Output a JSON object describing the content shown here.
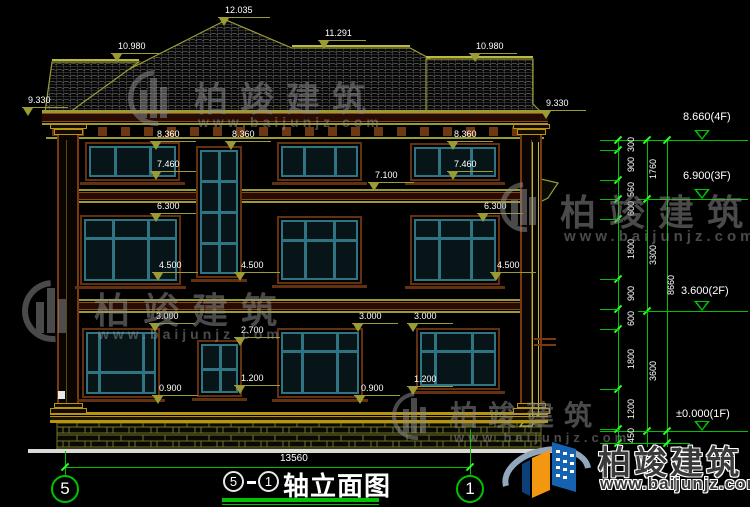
{
  "drawing": {
    "title": "轴立面图",
    "axis_left": "5",
    "axis_right": "1",
    "title_dash": "-",
    "bottom_overall_dim": "13560"
  },
  "watermark": {
    "name": "柏竣建筑",
    "url": "www.baijunjz.com"
  },
  "brand": {
    "name": "柏竣建筑",
    "url": "www.baijunjz.com"
  },
  "colors": {
    "background": "#000000",
    "dim_olive": "#9b9b33",
    "green": "#00c300",
    "window_teal": "#2e7482",
    "trim_brown": "#63310f",
    "base_yellow": "#b8960b",
    "white": "#ffffff",
    "logo_blue": "#1563b0",
    "logo_orange": "#f2970f"
  },
  "facade_dims": [
    {
      "label": "12.035",
      "tx": 225,
      "ty": 5,
      "lx": 218,
      "ly": 17,
      "lw": 52
    },
    {
      "label": "10.980",
      "tx": 118,
      "ty": 41,
      "lx": 111,
      "ly": 53,
      "lw": 48
    },
    {
      "label": "11.291",
      "tx": 325,
      "ty": 28,
      "lx": 318,
      "ly": 40,
      "lw": 48
    },
    {
      "label": "10.980",
      "tx": 476,
      "ty": 41,
      "lx": 469,
      "ly": 53,
      "lw": 48
    },
    {
      "label": "9.330",
      "tx": 28,
      "ty": 95,
      "lx": 22,
      "ly": 107,
      "lw": 46
    },
    {
      "label": "9.330",
      "tx": 546,
      "ty": 98,
      "lx": 540,
      "ly": 110,
      "lw": 46
    },
    {
      "label": "8.360",
      "tx": 157,
      "ty": 129,
      "lx": 150,
      "ly": 141,
      "lw": 46
    },
    {
      "label": "8.360",
      "tx": 232,
      "ty": 129,
      "lx": 225,
      "ly": 141,
      "lw": 46
    },
    {
      "label": "8.360",
      "tx": 454,
      "ty": 129,
      "lx": 447,
      "ly": 141,
      "lw": 46
    },
    {
      "label": "7.460",
      "tx": 157,
      "ty": 159,
      "lx": 150,
      "ly": 171,
      "lw": 46
    },
    {
      "label": "7.460",
      "tx": 454,
      "ty": 159,
      "lx": 447,
      "ly": 171,
      "lw": 46
    },
    {
      "label": "7.100",
      "tx": 375,
      "ty": 170,
      "lx": 368,
      "ly": 182,
      "lw": 46
    },
    {
      "label": "6.300",
      "tx": 157,
      "ty": 201,
      "lx": 150,
      "ly": 213,
      "lw": 46
    },
    {
      "label": "6.300",
      "tx": 484,
      "ty": 201,
      "lx": 477,
      "ly": 213,
      "lw": 46
    },
    {
      "label": "4.500",
      "tx": 159,
      "ty": 260,
      "lx": 152,
      "ly": 272,
      "lw": 46
    },
    {
      "label": "4.500",
      "tx": 241,
      "ty": 260,
      "lx": 234,
      "ly": 272,
      "lw": 46
    },
    {
      "label": "4.500",
      "tx": 497,
      "ty": 260,
      "lx": 490,
      "ly": 272,
      "lw": 46
    },
    {
      "label": "3.000",
      "tx": 156,
      "ty": 311,
      "lx": 149,
      "ly": 323,
      "lw": 46
    },
    {
      "label": "3.000",
      "tx": 359,
      "ty": 311,
      "lx": 352,
      "ly": 323,
      "lw": 46
    },
    {
      "label": "3.000",
      "tx": 414,
      "ty": 311,
      "lx": 407,
      "ly": 323,
      "lw": 46
    },
    {
      "label": "2.700",
      "tx": 241,
      "ty": 325,
      "lx": 234,
      "ly": 337,
      "lw": 46
    },
    {
      "label": "1.200",
      "tx": 241,
      "ty": 373,
      "lx": 234,
      "ly": 385,
      "lw": 46
    },
    {
      "label": "1.200",
      "tx": 414,
      "ty": 374,
      "lx": 407,
      "ly": 386,
      "lw": 46
    },
    {
      "label": "0.900",
      "tx": 159,
      "ty": 383,
      "lx": 152,
      "ly": 395,
      "lw": 46
    },
    {
      "label": "0.900",
      "tx": 361,
      "ty": 383,
      "lx": 354,
      "ly": 395,
      "lw": 46
    }
  ],
  "right_chain": {
    "col1": [
      {
        "label": "300",
        "y1": 140,
        "y2": 150
      },
      {
        "label": "900",
        "y1": 150,
        "y2": 180
      },
      {
        "label": "560",
        "y1": 180,
        "y2": 199
      },
      {
        "label": "600",
        "y1": 199,
        "y2": 219
      },
      {
        "label": "1800",
        "y1": 219,
        "y2": 279
      },
      {
        "label": "900",
        "y1": 279,
        "y2": 309
      },
      {
        "label": "600",
        "y1": 309,
        "y2": 329
      },
      {
        "label": "1800",
        "y1": 329,
        "y2": 389
      },
      {
        "label": "1200",
        "y1": 389,
        "y2": 429
      },
      {
        "label": "450",
        "y1": 429,
        "y2": 443
      }
    ],
    "col2": [
      {
        "label": "1760",
        "y1": 140,
        "y2": 199
      },
      {
        "label": "3300",
        "y1": 199,
        "y2": 311
      },
      {
        "label": "3600",
        "y1": 311,
        "y2": 431
      }
    ],
    "col3": [
      {
        "label": "8660",
        "y1": 140,
        "y2": 431
      }
    ],
    "levels": [
      {
        "label": "8.660(4F)",
        "tx": 683,
        "ty": 111,
        "y": 140
      },
      {
        "label": "6.900(3F)",
        "tx": 683,
        "ty": 170,
        "y": 199
      },
      {
        "label": "3.600(2F)",
        "tx": 681,
        "ty": 285,
        "y": 311
      },
      {
        "label": "±0.000(1F)",
        "tx": 676,
        "ty": 408,
        "y": 431
      }
    ]
  },
  "geometry": {
    "green_verticals": [
      {
        "x": 618,
        "y1": 140,
        "y2": 447
      },
      {
        "x": 647,
        "y1": 140,
        "y2": 447
      },
      {
        "x": 667,
        "y1": 140,
        "y2": 447
      },
      {
        "x": 65,
        "y1": 451,
        "y2": 476
      },
      {
        "x": 470,
        "y1": 429,
        "y2": 476
      }
    ],
    "green_hlines": [
      {
        "x1": 600,
        "x2": 748,
        "y": 140
      },
      {
        "x1": 640,
        "x2": 748,
        "y": 199
      },
      {
        "x1": 640,
        "x2": 748,
        "y": 311
      },
      {
        "x1": 600,
        "x2": 748,
        "y": 431
      },
      {
        "x1": 600,
        "x2": 690,
        "y": 443
      },
      {
        "x1": 65,
        "x2": 470,
        "y": 467
      }
    ],
    "ticks": [
      {
        "x": 618,
        "ys": [
          140,
          150,
          180,
          199,
          219,
          279,
          309,
          329,
          389,
          429,
          443
        ]
      },
      {
        "x": 647,
        "ys": [
          140,
          199,
          311,
          431
        ]
      },
      {
        "x": 667,
        "ys": [
          140,
          431,
          443
        ]
      },
      {
        "x": 65,
        "ys": [
          467
        ]
      },
      {
        "x": 470,
        "ys": [
          467
        ]
      }
    ],
    "connectors": [
      {
        "x": 600,
        "w": 20,
        "ys": [
          150,
          180,
          199,
          219,
          279,
          309,
          329,
          389,
          429,
          443
        ]
      },
      {
        "x": 638,
        "w": 11,
        "ys": [
          199,
          311,
          431
        ]
      }
    ],
    "windows": [
      {
        "x": 85,
        "y": 142,
        "w": 95,
        "h": 39,
        "v": [
          0.3,
          0.7
        ],
        "hz": []
      },
      {
        "x": 196,
        "y": 146,
        "w": 46,
        "h": 132,
        "v": [
          0.5
        ],
        "hz": [
          0.25,
          0.5,
          0.75
        ]
      },
      {
        "x": 277,
        "y": 142,
        "w": 85,
        "h": 39,
        "v": [
          0.3,
          0.7
        ],
        "hz": []
      },
      {
        "x": 410,
        "y": 143,
        "w": 90,
        "h": 38,
        "v": [
          0.3,
          0.69
        ],
        "hz": []
      },
      {
        "x": 80,
        "y": 215,
        "w": 101,
        "h": 70,
        "v": [
          0.31,
          0.69
        ],
        "hz": [
          0.31
        ]
      },
      {
        "x": 277,
        "y": 216,
        "w": 85,
        "h": 68,
        "v": [
          0.31,
          0.69
        ],
        "hz": [
          0.33
        ]
      },
      {
        "x": 410,
        "y": 215,
        "w": 90,
        "h": 70,
        "v": [
          0.3,
          0.69
        ],
        "hz": [
          0.31
        ]
      },
      {
        "x": 82,
        "y": 328,
        "w": 78,
        "h": 70,
        "v": [
          0.19,
          0.82
        ],
        "hz": [
          0.65
        ]
      },
      {
        "x": 197,
        "y": 340,
        "w": 45,
        "h": 57,
        "v": [
          0.5
        ],
        "hz": [
          0.5
        ]
      },
      {
        "x": 277,
        "y": 328,
        "w": 86,
        "h": 70,
        "v": [
          0.27,
          0.72
        ],
        "hz": [
          0.31
        ]
      },
      {
        "x": 416,
        "y": 328,
        "w": 84,
        "h": 62,
        "v": [
          0.2,
          0.68
        ],
        "hz": [
          0.35
        ]
      }
    ],
    "watermarks": [
      {
        "x": 128,
        "y": 70,
        "s": 56,
        "ts": 34,
        "ws": 14
      },
      {
        "x": 500,
        "y": 182,
        "s": 50,
        "ts": 36,
        "ws": 15
      },
      {
        "x": 22,
        "y": 280,
        "s": 62,
        "ts": 36,
        "ws": 14
      },
      {
        "x": 392,
        "y": 392,
        "s": 48,
        "ts": 28,
        "ws": 13
      }
    ]
  }
}
